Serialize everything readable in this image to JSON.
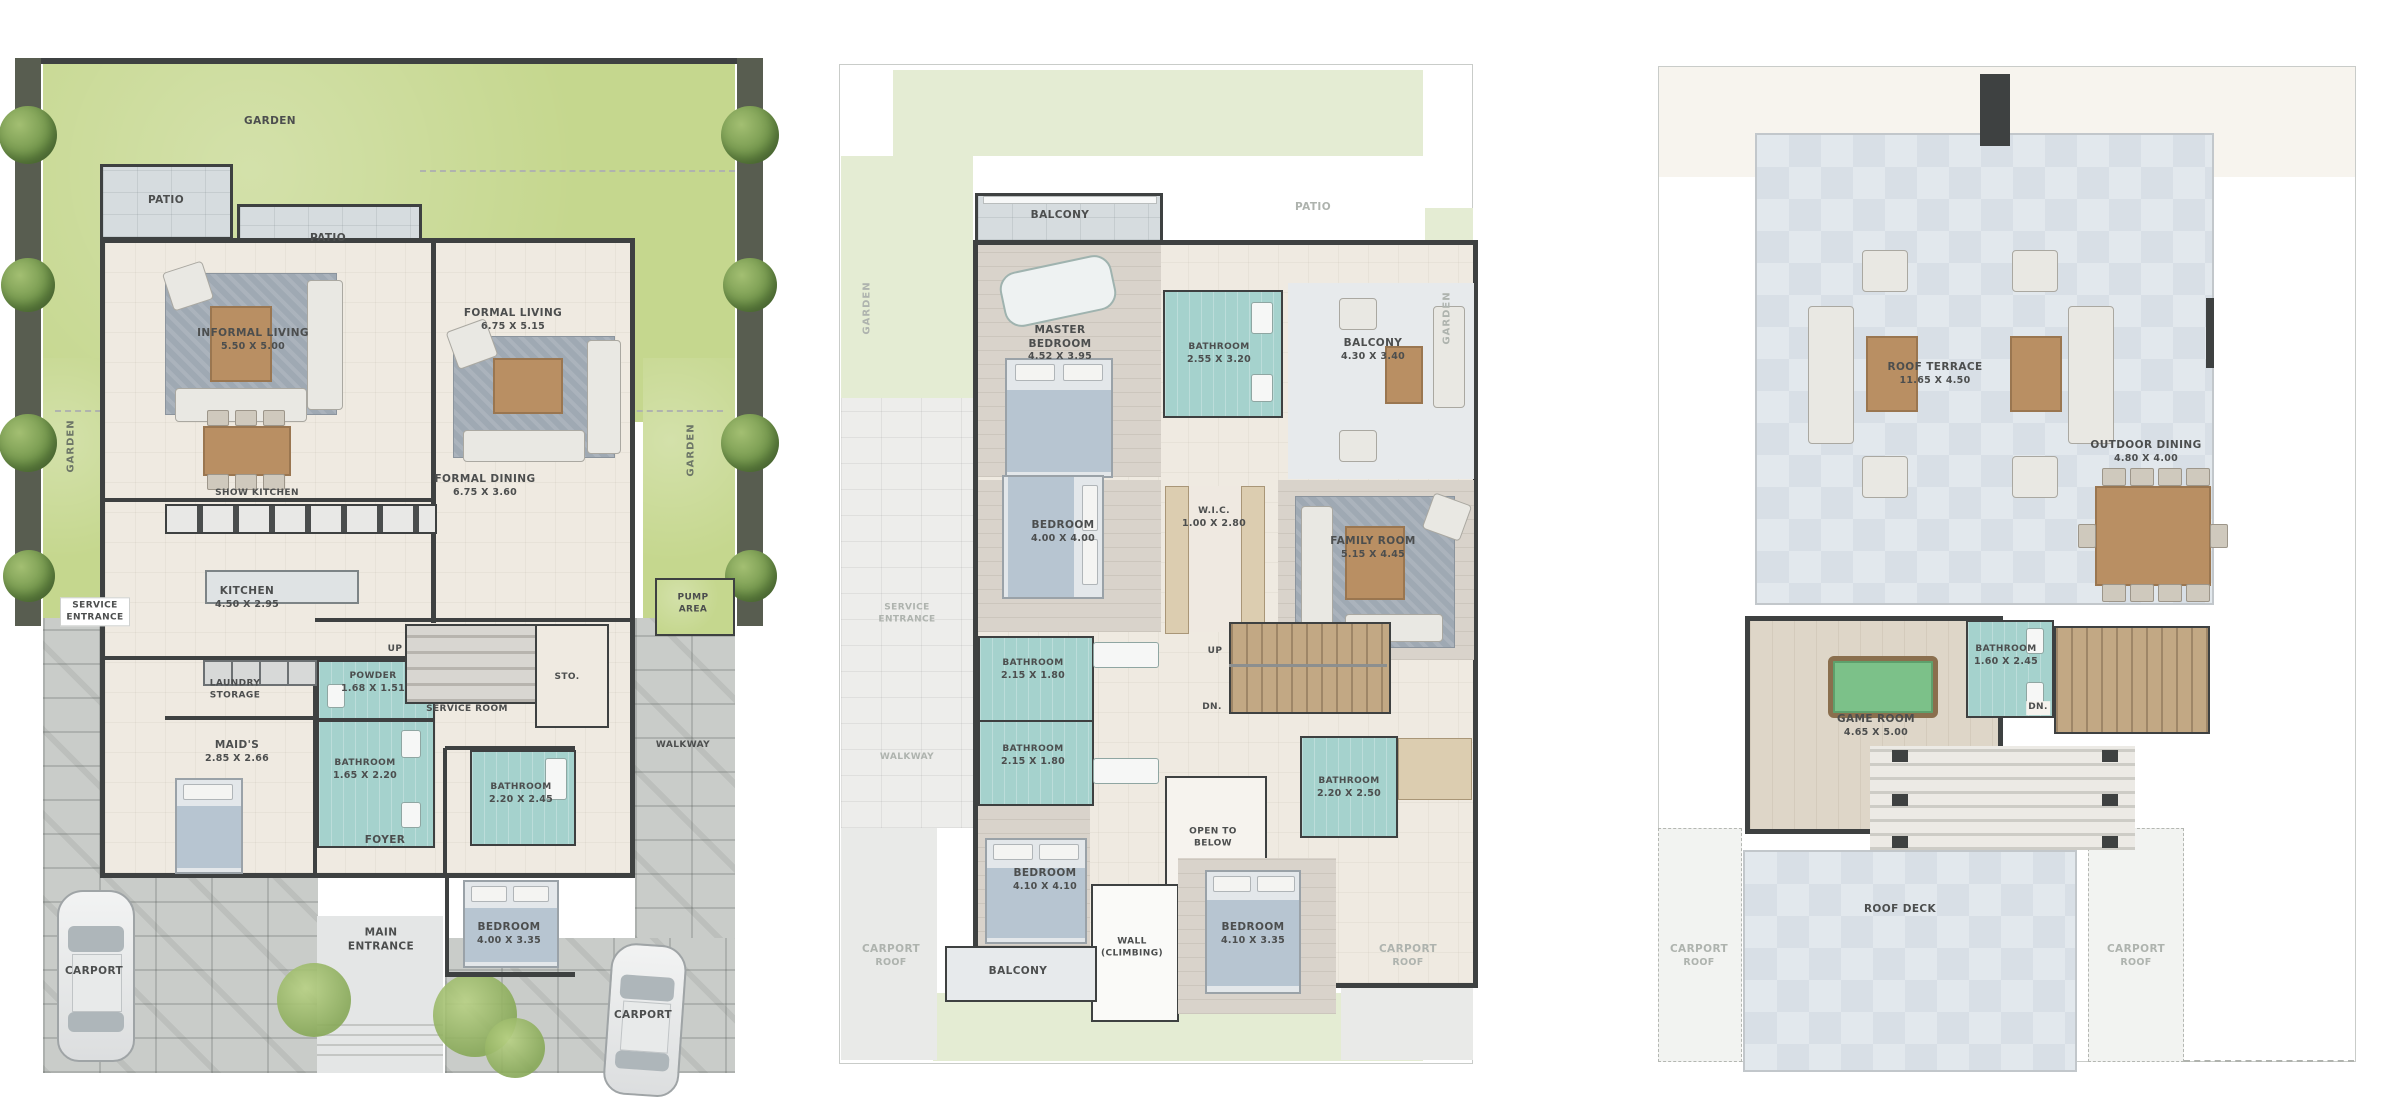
{
  "plans": {
    "ground": {
      "garden_top": "GARDEN",
      "garden_left": "GARDEN",
      "garden_right": "GARDEN",
      "patio_left": "PATIO",
      "patio_right": "PATIO",
      "informal_living": {
        "label": "INFORMAL LIVING",
        "dims": "5.50 X 5.00"
      },
      "formal_living": {
        "label": "FORMAL LIVING",
        "dims": "6.75 X 5.15"
      },
      "formal_dining": {
        "label": "FORMAL DINING",
        "dims": "6.75 X 3.60"
      },
      "show_kitchen": {
        "label": "SHOW KITCHEN"
      },
      "kitchen": {
        "label": "KITCHEN",
        "dims": "4.50 X 2.95"
      },
      "service_entrance": {
        "label": "SERVICE ENTRANCE"
      },
      "laundry_storage": {
        "label": "LAUNDRY STORAGE"
      },
      "powder": {
        "label": "POWDER",
        "dims": "1.68 X 1.51"
      },
      "maids": {
        "label": "MAID'S",
        "dims": "2.85 X 2.66"
      },
      "maids_bathroom": {
        "label": "BATHROOM",
        "dims": "1.65 X 2.20"
      },
      "up": "UP",
      "service_room": {
        "label": "SERVICE ROOM"
      },
      "sto": {
        "label": "STO."
      },
      "pump_area": {
        "label": "PUMP AREA"
      },
      "walkway": {
        "label": "WALKWAY"
      },
      "bathroom": {
        "label": "BATHROOM",
        "dims": "2.20 X 2.45"
      },
      "foyer": {
        "label": "FOYER"
      },
      "main_entrance": {
        "label": "MAIN ENTRANCE"
      },
      "bedroom": {
        "label": "BEDROOM",
        "dims": "4.00 X 3.35"
      },
      "carport_left": {
        "label": "CARPORT"
      },
      "carport_right": {
        "label": "CARPORT"
      }
    },
    "first": {
      "balcony_top": "BALCONY",
      "patio_ghost": "PATIO",
      "garden_left": "GARDEN",
      "garden_right": "GARDEN",
      "service_entrance_ghost": "SERVICE ENTRANCE",
      "walkway_ghost": "WALKWAY",
      "master_bedroom": {
        "label": "MASTER BEDROOM",
        "dims": "4.52 X 3.95"
      },
      "master_bathroom": {
        "label": "BATHROOM",
        "dims": "2.55 X 3.20"
      },
      "balcony_right": {
        "label": "BALCONY",
        "dims": "4.30 X 3.40"
      },
      "bedroom_left": {
        "label": "BEDROOM",
        "dims": "4.00 X 4.00"
      },
      "wic": {
        "label": "W.I.C.",
        "dims": "1.00 X 2.80"
      },
      "family_room": {
        "label": "FAMILY ROOM",
        "dims": "5.15 X 4.45"
      },
      "bathroom_1": {
        "label": "BATHROOM",
        "dims": "2.15 X 1.80"
      },
      "bathroom_2": {
        "label": "BATHROOM",
        "dims": "2.15 X 1.80"
      },
      "up": "UP",
      "dn": "DN.",
      "open_to_below": {
        "label": "OPEN",
        "label2": "TO BELOW"
      },
      "bathroom_right": {
        "label": "BATHROOM",
        "dims": "2.20 X 2.50"
      },
      "bedroom_bottom_left": {
        "label": "BEDROOM",
        "dims": "4.10 X 4.10"
      },
      "bedroom_bottom_right": {
        "label": "BEDROOM",
        "dims": "4.10 X 3.35"
      },
      "wall_climbing": {
        "label": "WALL",
        "label2": "(CLIMBING)"
      },
      "balcony_bottom": "BALCONY",
      "carport_roof_left": {
        "label": "CARPORT",
        "label2": "ROOF"
      },
      "carport_roof_right": {
        "label": "CARPORT",
        "label2": "ROOF"
      }
    },
    "roof": {
      "roof_terrace": {
        "label": "ROOF TERRACE",
        "dims": "11.65 X 4.50"
      },
      "outdoor_dining": {
        "label": "OUTDOOR DINING",
        "dims": "4.80 X 4.00"
      },
      "game_room": {
        "label": "GAME ROOM",
        "dims": "4.65 X 5.00"
      },
      "bathroom": {
        "label": "BATHROOM",
        "dims": "1.60 X 2.45"
      },
      "dn": "DN.",
      "roof_deck": {
        "label": "ROOF DECK"
      },
      "carport_roof_left": {
        "label": "CARPORT",
        "label2": "ROOF"
      },
      "carport_roof_right": {
        "label": "CARPORT",
        "label2": "ROOF"
      }
    }
  }
}
